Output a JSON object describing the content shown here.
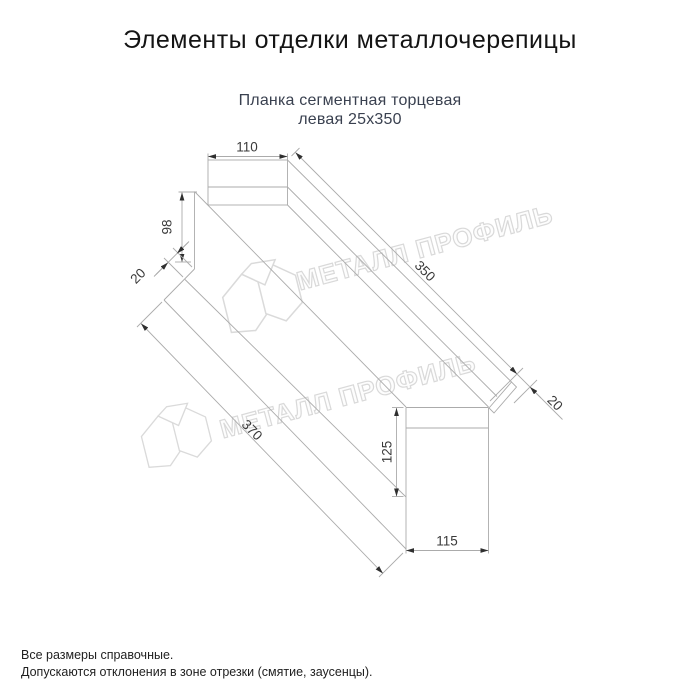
{
  "title": "Элементы отделки металлочерепицы",
  "subtitle": {
    "line1": "Планка сегментная торцевая",
    "line2": "левая 25х350"
  },
  "dimensions": {
    "top_width": "110",
    "left_height": "98",
    "left_hem": "20",
    "length_top": "350",
    "right_hem": "20",
    "length_bottom": "370",
    "right_height": "125",
    "right_width": "115"
  },
  "watermark": {
    "text": "МЕТАЛЛ ПРОФИЛЬ",
    "logo": "metall-profil-house-logo"
  },
  "notes": {
    "line1": "Все размеры справочные.",
    "line2": "Допускаются отклонения в зоне отрезки (смятие, заусенцы)."
  },
  "colors": {
    "background": "#ffffff",
    "title_text": "#141414",
    "subtitle_text": "#3a4150",
    "drawing_line": "#ababab",
    "arrow": "#2f2f2f",
    "dimension_text": "#3a3a3a",
    "watermark": "#d9d9d9"
  }
}
